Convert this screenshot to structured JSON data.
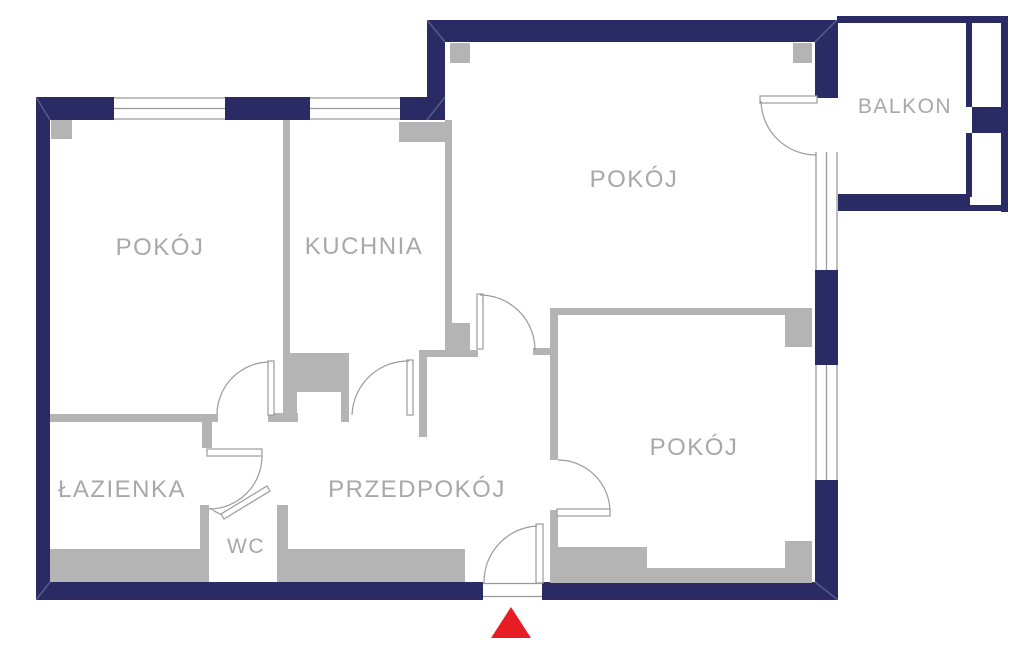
{
  "floorplan": {
    "type": "apartment-floor-plan",
    "rooms": [
      {
        "id": "pokoj-left",
        "label": "POKÓJ"
      },
      {
        "id": "kuchnia",
        "label": "KUCHNIA"
      },
      {
        "id": "pokoj-top",
        "label": "POKÓJ"
      },
      {
        "id": "balkon",
        "label": "BALKON"
      },
      {
        "id": "pokoj-bottom",
        "label": "POKÓJ"
      },
      {
        "id": "lazienka",
        "label": "ŁAZIENKA"
      },
      {
        "id": "przedpokoj",
        "label": "PRZEDPOKÓJ"
      },
      {
        "id": "wc",
        "label": "WC"
      }
    ],
    "colors": {
      "exterior_wall": "#2a2b64",
      "interior_wall": "#b4b4b4",
      "opening_line": "#9b9b9b",
      "room_label": "#a8a8a8",
      "entrance_marker": "#e81c24",
      "background": "#ffffff"
    },
    "entrance": {
      "marker": "red-triangle-up",
      "position": "bottom-center"
    }
  }
}
